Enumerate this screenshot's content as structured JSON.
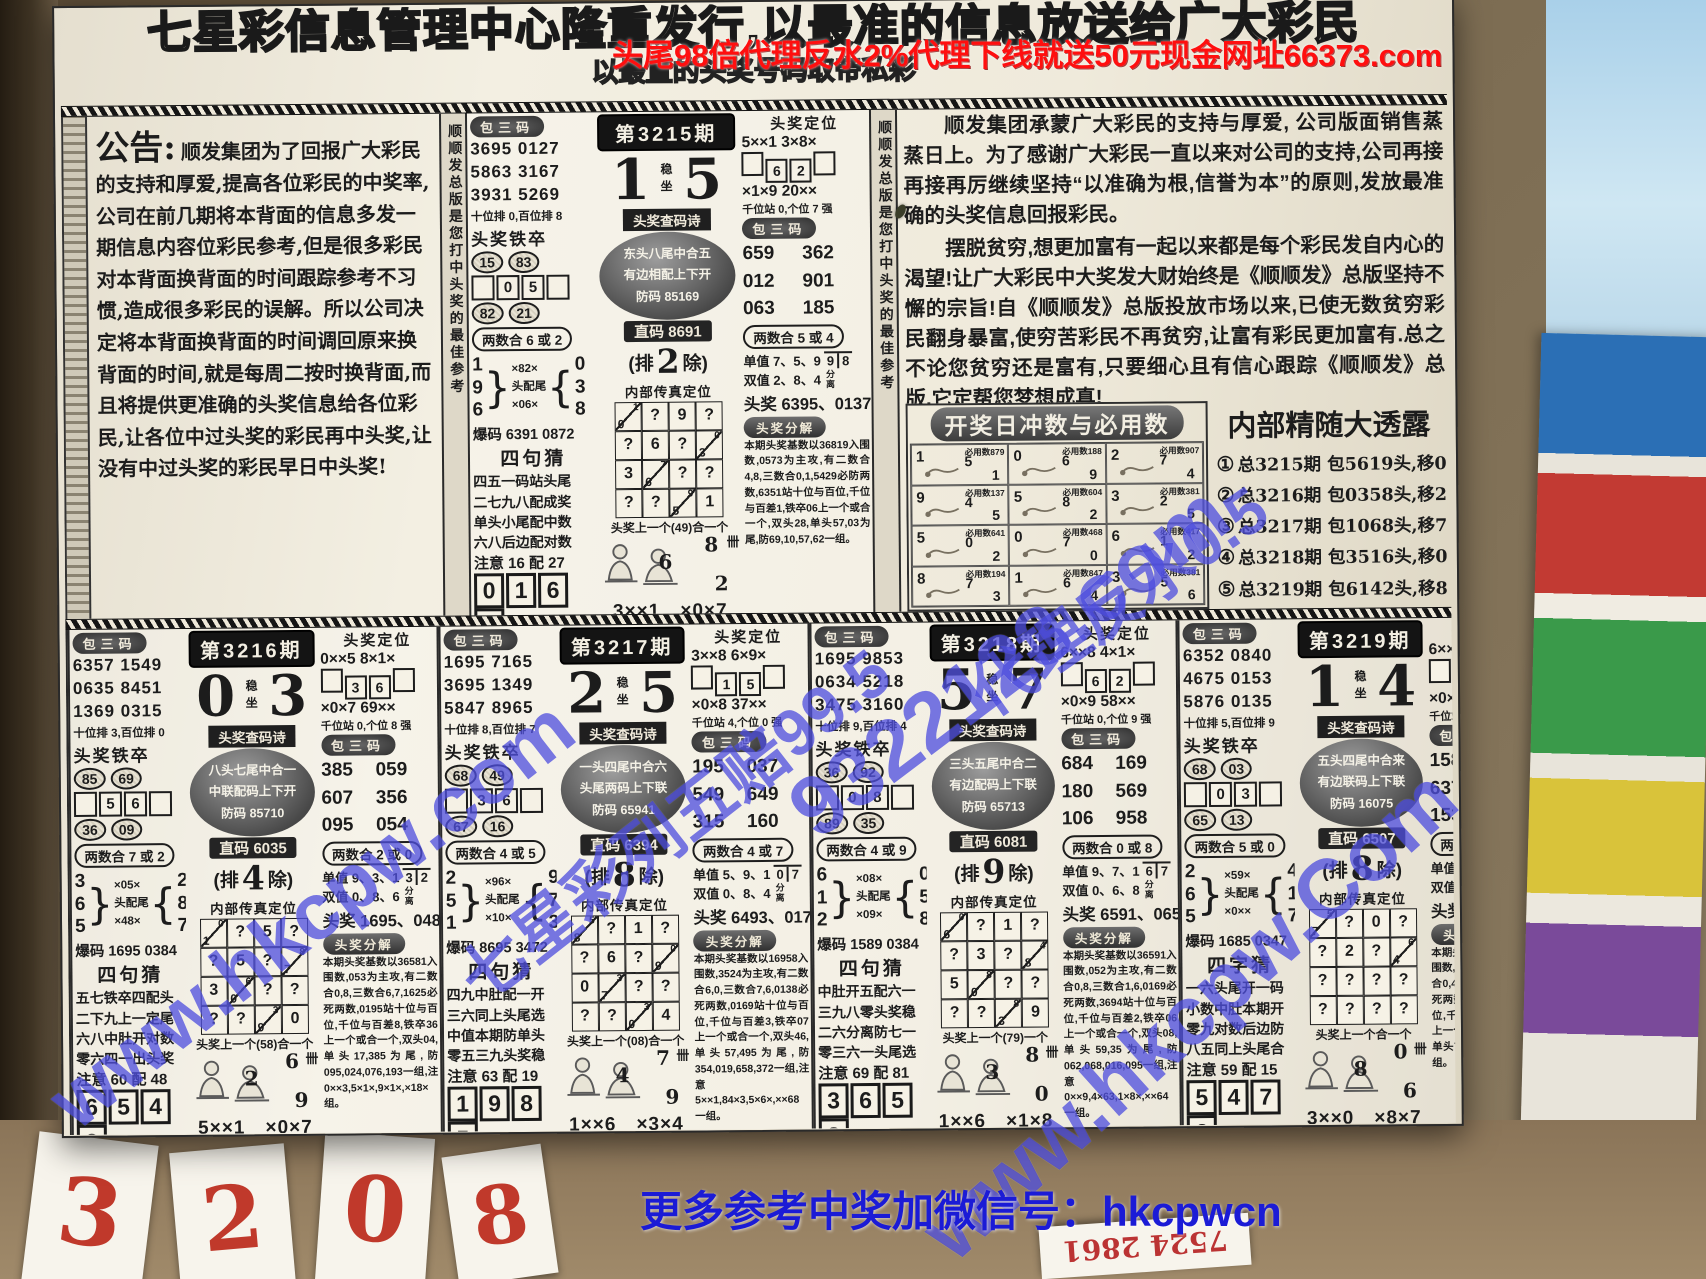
{
  "overlays": {
    "top_banner": "头尾98倍代理反水2%代理下线就送50元现金网址66373.com",
    "bottom_banner": "更多参考中奖加微信号：hkcpwcn",
    "wm_hkcpw": "www.hkcpw.com",
    "wm_hkcpw2": "www.hkcpw.Com",
    "wm_site": "9322123.com",
    "wm_odds": "七星彩列五赔99.5",
    "wm_rebate": "代理反水0.5"
  },
  "masthead": {
    "line1": "七星彩信息管理中心隆重发行,以最准的信息放送给广大彩民",
    "line2": "以最直的头奖号码取帝私彩"
  },
  "announcement": {
    "title": "公告:",
    "body": "顺发集团为了回报广大彩民的支持和厚爱,提高各位彩民的中奖率,公司在前几期将本背面的信息多发一期信息内容位彩民参考,但是很多彩民对本背面换背面的时间跟踪参考不习惯,造成很多彩民的误解。所以公司决定将本背面换背面的时间调回原来换背面的时间,就是每周二按时换背面,而且将提供更准确的头奖信息给各位彩民,让各位中过头奖的彩民再中头奖,让没有中过头奖的彩民早日中头奖!"
  },
  "article": {
    "para1": "顺发集团承蒙广大彩民的支持与厚爱, 公司版面销售蒸蒸日上。为了感谢广大彩民一直以来对公司的支持,公司再接再接再厉继续坚持“以准确为根,信誉为本”的原则,发放最准确的头奖信息回报彩民。",
    "para2": "摆脱贫穷,想更加富有一起以来都是每个彩民发自内心的渴望!让广大彩民中大奖发大财始终是《顺顺发》总版坚持不懈的宗旨!自《顺顺发》总版投放市场以来,已使无数贫穷彩民翻身暴富,使穷苦彩民不再贫穷,让富有彩民更加富有.总之不论您贫穷还是富有,只要细心且有信心跟踪《顺顺发》总版,它定帮您梦想成真!"
  },
  "zodiac": {
    "title": "开奖日冲数与必用数",
    "cells": [
      {
        "n": [
          "1",
          "5",
          "1"
        ],
        "by": "必用数879"
      },
      {
        "n": [
          "0",
          "6",
          "9"
        ],
        "by": "必用数188"
      },
      {
        "n": [
          "2",
          "7",
          "4"
        ],
        "by": "必用数907"
      },
      {
        "n": [
          "9",
          "4",
          "5"
        ],
        "by": "必用数137"
      },
      {
        "n": [
          "5",
          "8",
          "2"
        ],
        "by": "必用数604"
      },
      {
        "n": [
          "3",
          "2",
          "5"
        ],
        "by": "必用数381"
      },
      {
        "n": [
          "5",
          "0",
          "2"
        ],
        "by": "必用数641"
      },
      {
        "n": [
          "0",
          "7",
          "0"
        ],
        "by": "必用数468"
      },
      {
        "n": [
          "6",
          "1",
          "2"
        ],
        "by": "必用数417"
      },
      {
        "n": [
          "8",
          "7",
          "3"
        ],
        "by": "必用数194"
      },
      {
        "n": [
          "1",
          "6",
          "4"
        ],
        "by": "必用数847"
      },
      {
        "n": [
          "3",
          "5",
          "6"
        ],
        "by": "必用数381"
      }
    ]
  },
  "reveal": {
    "title": "内部精随大透露",
    "items": [
      {
        "c": "①",
        "t": "总3215期 包5619头,移04中奖。"
      },
      {
        "c": "②",
        "t": "总3216期 包0358头,移27中奖。"
      },
      {
        "c": "③",
        "t": "总3217期 包1068头,移71中奖。"
      },
      {
        "c": "④",
        "t": "总3218期 包3516头,移03中奖。"
      },
      {
        "c": "⑤",
        "t": "总3219期 包6142头,移89中奖。"
      }
    ]
  },
  "labels": {
    "bao3": "包三码",
    "tiezu": "头奖铁卒",
    "baoma": "爆码",
    "stable": "稳坐",
    "poem_badge": "头奖查码诗",
    "pai_l": "(排",
    "pai_r": "除)",
    "neibu": "内部传真定位",
    "dingwei": "头奖定位",
    "fenli": "分离",
    "fenjie": "头奖分解",
    "tally": "卌"
  },
  "sidebar_text": "顺顺发总版是您打中头奖的最佳参考",
  "panels": [
    {
      "period": "第3215期",
      "d1": "1",
      "d2": "5",
      "bao_left": [
        "3695 0127",
        "5863 3167",
        "3931 5269"
      ],
      "wei_note": "十位排 0,百位排 8",
      "tiezu_top": [
        "15",
        "83"
      ],
      "tiezu_mid": [
        "0",
        "5"
      ],
      "tiezu_bot": [
        "82",
        "21"
      ],
      "hs_left": "两数合 6 或 2",
      "br_l": [
        "1",
        "9",
        "6"
      ],
      "br_m": [
        "×82×",
        "头配尾",
        "×06×"
      ],
      "br_r": [
        "0",
        "3",
        "8"
      ],
      "baoma": "6391 0872",
      "sj_title": "四句猜",
      "sj": [
        "四五一码站头尾",
        "二七九八配成奖",
        "单头小尾配中数",
        "六八后边配对数"
      ],
      "sj_note": "注意 16 配 27",
      "rbox": [
        "0",
        "1",
        "6",
        "3"
      ],
      "poem": [
        "东头八尾中合五",
        "有边相配上下开",
        "防码 85169"
      ],
      "zhima": "直码 8691",
      "pai_n": "2",
      "grid": [
        "d:1,0",
        "?",
        "9",
        "?",
        "?",
        "6",
        "?",
        "d:0,3",
        "3",
        "d:7,6",
        "?",
        "?",
        "?",
        "?",
        "d:9,5",
        "1"
      ],
      "grid_note": "头奖上一个(49)合一个",
      "mn": [
        "6",
        "8",
        "2"
      ],
      "pattern": "3××1　×0×7",
      "dw1": "5××1 3×8×",
      "dw_boxes": [
        "6",
        "2"
      ],
      "dw2": "×1×9 20××",
      "dw_note": "千位站 0,个位 7 强",
      "bao_right": [
        "659",
        "362",
        "012",
        "901",
        "063",
        "185"
      ],
      "hs_right": "两数合 5 或 4",
      "dan_label": "单值 7、5、9",
      "dan_frac": [
        "9",
        "8"
      ],
      "shuang_label": "双值 2、8、4",
      "toujiang": "头奖 6395、0137",
      "fenjie": "本期头奖基数以36819入围数,0573为主攻,有二数合4,8,三数合0,1,5429必防两数,6351站十位与百位,千位与百差1,铁卒06上一个或合一个,双头28,单头57,03为尾,防69,10,57,62一组。"
    },
    {
      "period": "第3216期",
      "d1": "0",
      "d2": "3",
      "bao_left": [
        "6357 1549",
        "0635 8451",
        "1369 0315"
      ],
      "wei_note": "十位排 3,百位排 0",
      "tiezu_top": [
        "85",
        "69"
      ],
      "tiezu_mid": [
        "5",
        "6"
      ],
      "tiezu_bot": [
        "36",
        "09"
      ],
      "hs_left": "两数合 7 或 2",
      "br_l": [
        "3",
        "6",
        "5"
      ],
      "br_m": [
        "×05×",
        "头配尾",
        "×48×"
      ],
      "br_r": [
        "2",
        "8",
        "7"
      ],
      "baoma": "1695 0384",
      "sj_title": "四句猜",
      "sj": [
        "五七铁卒四配头",
        "二下九上一定尾",
        "六八中肚开对数",
        "零六四一出头奖"
      ],
      "sj_note": "注意 60 配 48",
      "rbox": [
        "6",
        "5",
        "4",
        "3"
      ],
      "poem": [
        "八头七尾中合一",
        "中联配码上下开",
        "防码 85710"
      ],
      "zhima": "直码 6035",
      "pai_n": "4",
      "grid": [
        "d:0,1",
        "?",
        "5",
        "?",
        "?",
        "5",
        "?",
        "d:8,7",
        "3",
        "d:6,0",
        "?",
        "?",
        "?",
        "?",
        "d:3,9",
        "0"
      ],
      "grid_note": "头奖上一个(58)合一个",
      "mn": [
        "2",
        "6",
        "9"
      ],
      "pattern": "5××1　×0×7",
      "dw1": "0××5 8×1×",
      "dw_boxes": [
        "3",
        "6"
      ],
      "dw2": "×0×7 69××",
      "dw_note": "千位站 0,个位 8 强",
      "bao_right": [
        "385",
        "059",
        "607",
        "356",
        "095",
        "054"
      ],
      "hs_right": "两数合 2 或 0",
      "dan_label": "单值 9、3、1",
      "dan_frac": [
        "3",
        "2"
      ],
      "shuang_label": "双值 0、8、6",
      "toujiang": "头奖 1695、0487",
      "fenjie": "本期头奖基数以36581入围数,053为主攻,有二数合0,8,三数合6,7,1625必死两数,0195站十位与百位,千位与百差8,铁卒36上一个或合一个,双头04,单头17,385为尾,防095,024,076,193一组,注0××3,5×1×,9×1×,×18×组。"
    },
    {
      "period": "第3217期",
      "d1": "2",
      "d2": "5",
      "bao_left": [
        "1695 7165",
        "3695 1349",
        "5847 8965"
      ],
      "wei_note": "十位排 8,百位排 7",
      "tiezu_top": [
        "68",
        "49"
      ],
      "tiezu_mid": [
        "3",
        "6"
      ],
      "tiezu_bot": [
        "67",
        "16"
      ],
      "hs_left": "两数合 4 或 5",
      "br_l": [
        "2",
        "5",
        "1"
      ],
      "br_m": [
        "×96×",
        "头配尾",
        "×10×"
      ],
      "br_r": [
        "9",
        "7",
        "3"
      ],
      "baoma": "8695 3472",
      "sj_title": "四句猜",
      "sj": [
        "四九中肚配一开",
        "三六同上头尾选",
        "中值本期防单头",
        "零五三九头奖稳"
      ],
      "sj_note": "注意 63 配 19",
      "rbox": [
        "1",
        "9",
        "8",
        "5"
      ],
      "poem": [
        "一头四尾中合六",
        "头尾两码上下联",
        "防码 65941"
      ],
      "zhima": "直码 6394",
      "pai_n": "8",
      "grid": [
        "d:5,8",
        "?",
        "1",
        "?",
        "?",
        "6",
        "?",
        "d:0,9",
        "0",
        "d:3,7",
        "?",
        "?",
        "?",
        "?",
        "d:3,0",
        "4"
      ],
      "grid_note": "头奖上一个(08)合一个",
      "mn": [
        "4",
        "7",
        "9"
      ],
      "pattern": "1××6　×3×4",
      "dw1": "3××8 6×9×",
      "dw_boxes": [
        "1",
        "5"
      ],
      "dw2": "×0×8 37××",
      "dw_note": "千位站 4,个位 0 强",
      "bao_right": [
        "195",
        "037",
        "549",
        "649",
        "315",
        "160"
      ],
      "hs_right": "两数合 4 或 7",
      "dan_label": "单值 5、9、1",
      "dan_frac": [
        "0",
        "7"
      ],
      "shuang_label": "双值 0、8、4",
      "toujiang": "头奖 6493、0174",
      "fenjie": "本期头奖基数以16958入围数,3524为主攻,有二数合6,0,三数合7,6,0138必死两数,0169站十位与百位,千位与百差3,铁卒07上一个或合一个,双头46,单头57,495为尾,防354,019,658,372一组,注意5××1,84×3,5×6×,××68一组。"
    },
    {
      "period": "第3218期",
      "d1": "5",
      "d2": "7",
      "bao_left": [
        "1695 9853",
        "0634 5218",
        "3475 3160"
      ],
      "wei_note": "十位排 9,百位排 4",
      "tiezu_top": [
        "36",
        "92"
      ],
      "tiezu_mid": [
        "0",
        "8"
      ],
      "tiezu_bot": [
        "89",
        "35"
      ],
      "hs_left": "两数合 4 或 9",
      "br_l": [
        "6",
        "1",
        "2"
      ],
      "br_m": [
        "×08×",
        "头配尾",
        "×09×"
      ],
      "br_r": [
        "0",
        "5",
        "8"
      ],
      "baoma": "1589 0384",
      "sj_title": "四句猜",
      "sj": [
        "中肚开五配六一",
        "三九八零头奖稳",
        "二六分离防七一",
        "零三六一头尾选"
      ],
      "sj_note": "注意 69 配 81",
      "rbox": [
        "3",
        "6",
        "5",
        "8"
      ],
      "poem": [
        "三头五尾中合二",
        "有边配码上下联",
        "防码 65713"
      ],
      "zhima": "直码 6081",
      "pai_n": "9",
      "grid": [
        "d:0,6",
        "?",
        "1",
        "?",
        "?",
        "3",
        "?",
        "d:4,8",
        "5",
        "d:8,0",
        "?",
        "?",
        "?",
        "?",
        "d:8,3",
        "9"
      ],
      "grid_note": "头奖上一个(79)一个",
      "mn": [
        "3",
        "8",
        "0"
      ],
      "pattern": "1××6　×1×8",
      "dw1": "6××8 4×1×",
      "dw_boxes": [
        "6",
        "2"
      ],
      "dw2": "×0×9 58××",
      "dw_note": "千位站 0,个位 9 强",
      "bao_right": [
        "684",
        "169",
        "180",
        "569",
        "106",
        "958"
      ],
      "hs_right": "两数合 0 或 8",
      "dan_label": "单值 9、7、1",
      "dan_frac": [
        "6",
        "7"
      ],
      "shuang_label": "双值 0、6、8",
      "toujiang": "头奖 6591、0659",
      "fenjie": "本期头奖基数以36591入围数,052为主攻,有二数合0,8,三数合1,6,0169必死两数,3694站十位与百位,千位与百差2,铁卒06上一个或合一个,双头08,单头59,35为尾,防062,068,016,095一组,注意0××9,4×63,1×8×,××64一组。"
    },
    {
      "period": "第3219期",
      "d1": "1",
      "d2": "4",
      "bao_left": [
        "6352 0840",
        "4675 0153",
        "5876 0135"
      ],
      "wei_note": "十位排 5,百位排 9",
      "tiezu_top": [
        "68",
        "03"
      ],
      "tiezu_mid": [
        "0",
        "3"
      ],
      "tiezu_bot": [
        "65",
        "13"
      ],
      "hs_left": "两数合 5 或 0",
      "br_l": [
        "2",
        "6",
        "5"
      ],
      "br_m": [
        "×59×",
        "头配尾",
        "×0××"
      ],
      "br_r": [
        "4",
        "1",
        "7"
      ],
      "baoma": "1685 0347",
      "sj_title": "四字猜",
      "sj": [
        "一六头尾开一码",
        "小数中肚本期开",
        "零九对数后边防",
        "八五同上头尾合"
      ],
      "sj_note": "注意 59 配 15",
      "rbox": [
        "5",
        "4",
        "7",
        "2"
      ],
      "poem": [
        "五头四尾中合来",
        "有边联码上下联",
        "防码 16075"
      ],
      "zhima": "直码 6507",
      "pai_n": "8",
      "grid": [
        "d:5,7",
        "?",
        "0",
        "?",
        "?",
        "2",
        "?",
        "d:6,4",
        "?",
        "?",
        "?",
        "?",
        "?",
        "?",
        "?",
        "?"
      ],
      "grid_note": "头奖上一个合一个",
      "mn": [
        "8",
        "0",
        "6"
      ],
      "pattern": "3××0　×8×7",
      "dw1": "6××0 5×4×",
      "dw_boxes": [
        "1",
        "7"
      ],
      "dw2": "×0×1 25××",
      "dw_note": "千位站 3,个位 1 强",
      "bao_right": [
        "158",
        "052",
        "637",
        "154",
        "153",
        "527"
      ],
      "hs_right": "两数合 5 或 1",
      "dan_label": "单值 1、9、3",
      "dan_frac": [
        "5",
        "9"
      ],
      "shuang_label": "双值 6、2、0",
      "toujiang": "头奖 6572、0139",
      "fenjie": "本期头奖基数以16852入围数,0347为主攻,有二数合0,4,三数合5,7,1529必死两数,0421站十位与百位,千位与百差8,铁卒08上一个或合一个,双头25,单头75,15为尾,防632一组。"
    }
  ],
  "bottom_tickets": [
    {
      "t": "3"
    },
    {
      "t": "2"
    },
    {
      "t": "0"
    },
    {
      "t": "8"
    },
    {
      "t": "7524 2861"
    }
  ]
}
